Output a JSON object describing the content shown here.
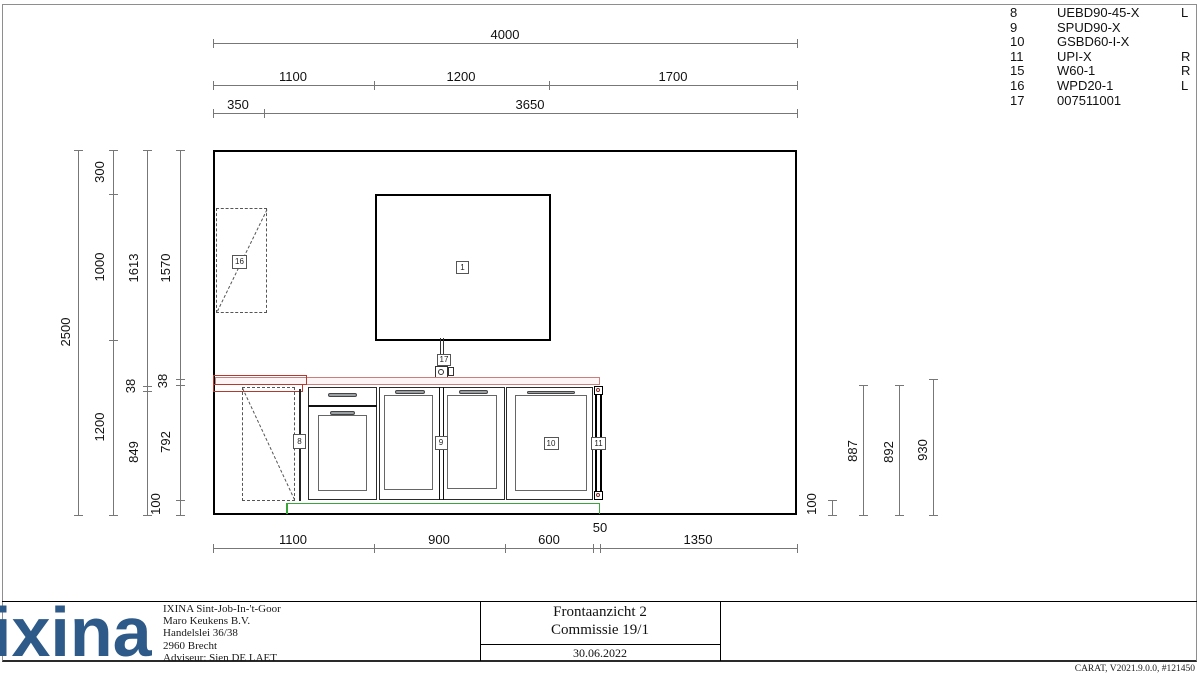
{
  "page": {
    "credit": "CARAT, V2021.9.0.0, #121450"
  },
  "parts_list": {
    "rows": [
      {
        "pos": "8",
        "code": "UEBD90-45-X",
        "hinge": "L"
      },
      {
        "pos": "9",
        "code": "SPUD90-X",
        "hinge": ""
      },
      {
        "pos": "10",
        "code": "GSBD60-I-X",
        "hinge": ""
      },
      {
        "pos": "11",
        "code": "UPI-X",
        "hinge": "R"
      },
      {
        "pos": "15",
        "code": "W60-1",
        "hinge": "R"
      },
      {
        "pos": "16",
        "code": "WPD20-1",
        "hinge": "L"
      },
      {
        "pos": "17",
        "code": "007511001",
        "hinge": ""
      }
    ]
  },
  "dims": {
    "top": {
      "total": "4000",
      "seg1": "1100",
      "seg2": "1200",
      "seg3": "1700",
      "offset": "350",
      "rest": "3650"
    },
    "left": {
      "total": "2500",
      "ceiling": "300",
      "window_h": "1000",
      "below": "1200",
      "c3a": "1613",
      "c3b": "38",
      "c3c": "849",
      "c4a": "1570",
      "c4b": "38",
      "c4c": "792",
      "c4d": "100"
    },
    "right": {
      "plinth": "100",
      "a": "887",
      "b": "892",
      "c": "930"
    },
    "bottom": {
      "s1": "1100",
      "s2": "900",
      "s3": "600",
      "s4": "50",
      "s5": "1350"
    }
  },
  "item_labels": {
    "window": "1",
    "corner_unit": "8",
    "sink_unit": "9",
    "dishwasher": "10",
    "panel": "11",
    "wall_unit": "16",
    "tap": "17"
  },
  "footer": {
    "logo": "ixina",
    "dealer_lines": [
      "IXINA Sint-Job-In-'t-Goor",
      "Maro Keukens B.V.",
      "Handelslei 36/38",
      "2960 Brecht",
      "Adviseur: Sien DE LAET"
    ],
    "view_title": "Frontaanzicht 2",
    "commission": "Commissie 19/1",
    "date": "30.06.2022"
  },
  "colors": {
    "logo_blue": "#2d5a88",
    "highlight_red": "#b43a30",
    "worktop_pink": "#c9807d",
    "plinth_green": "#3aa63a"
  }
}
